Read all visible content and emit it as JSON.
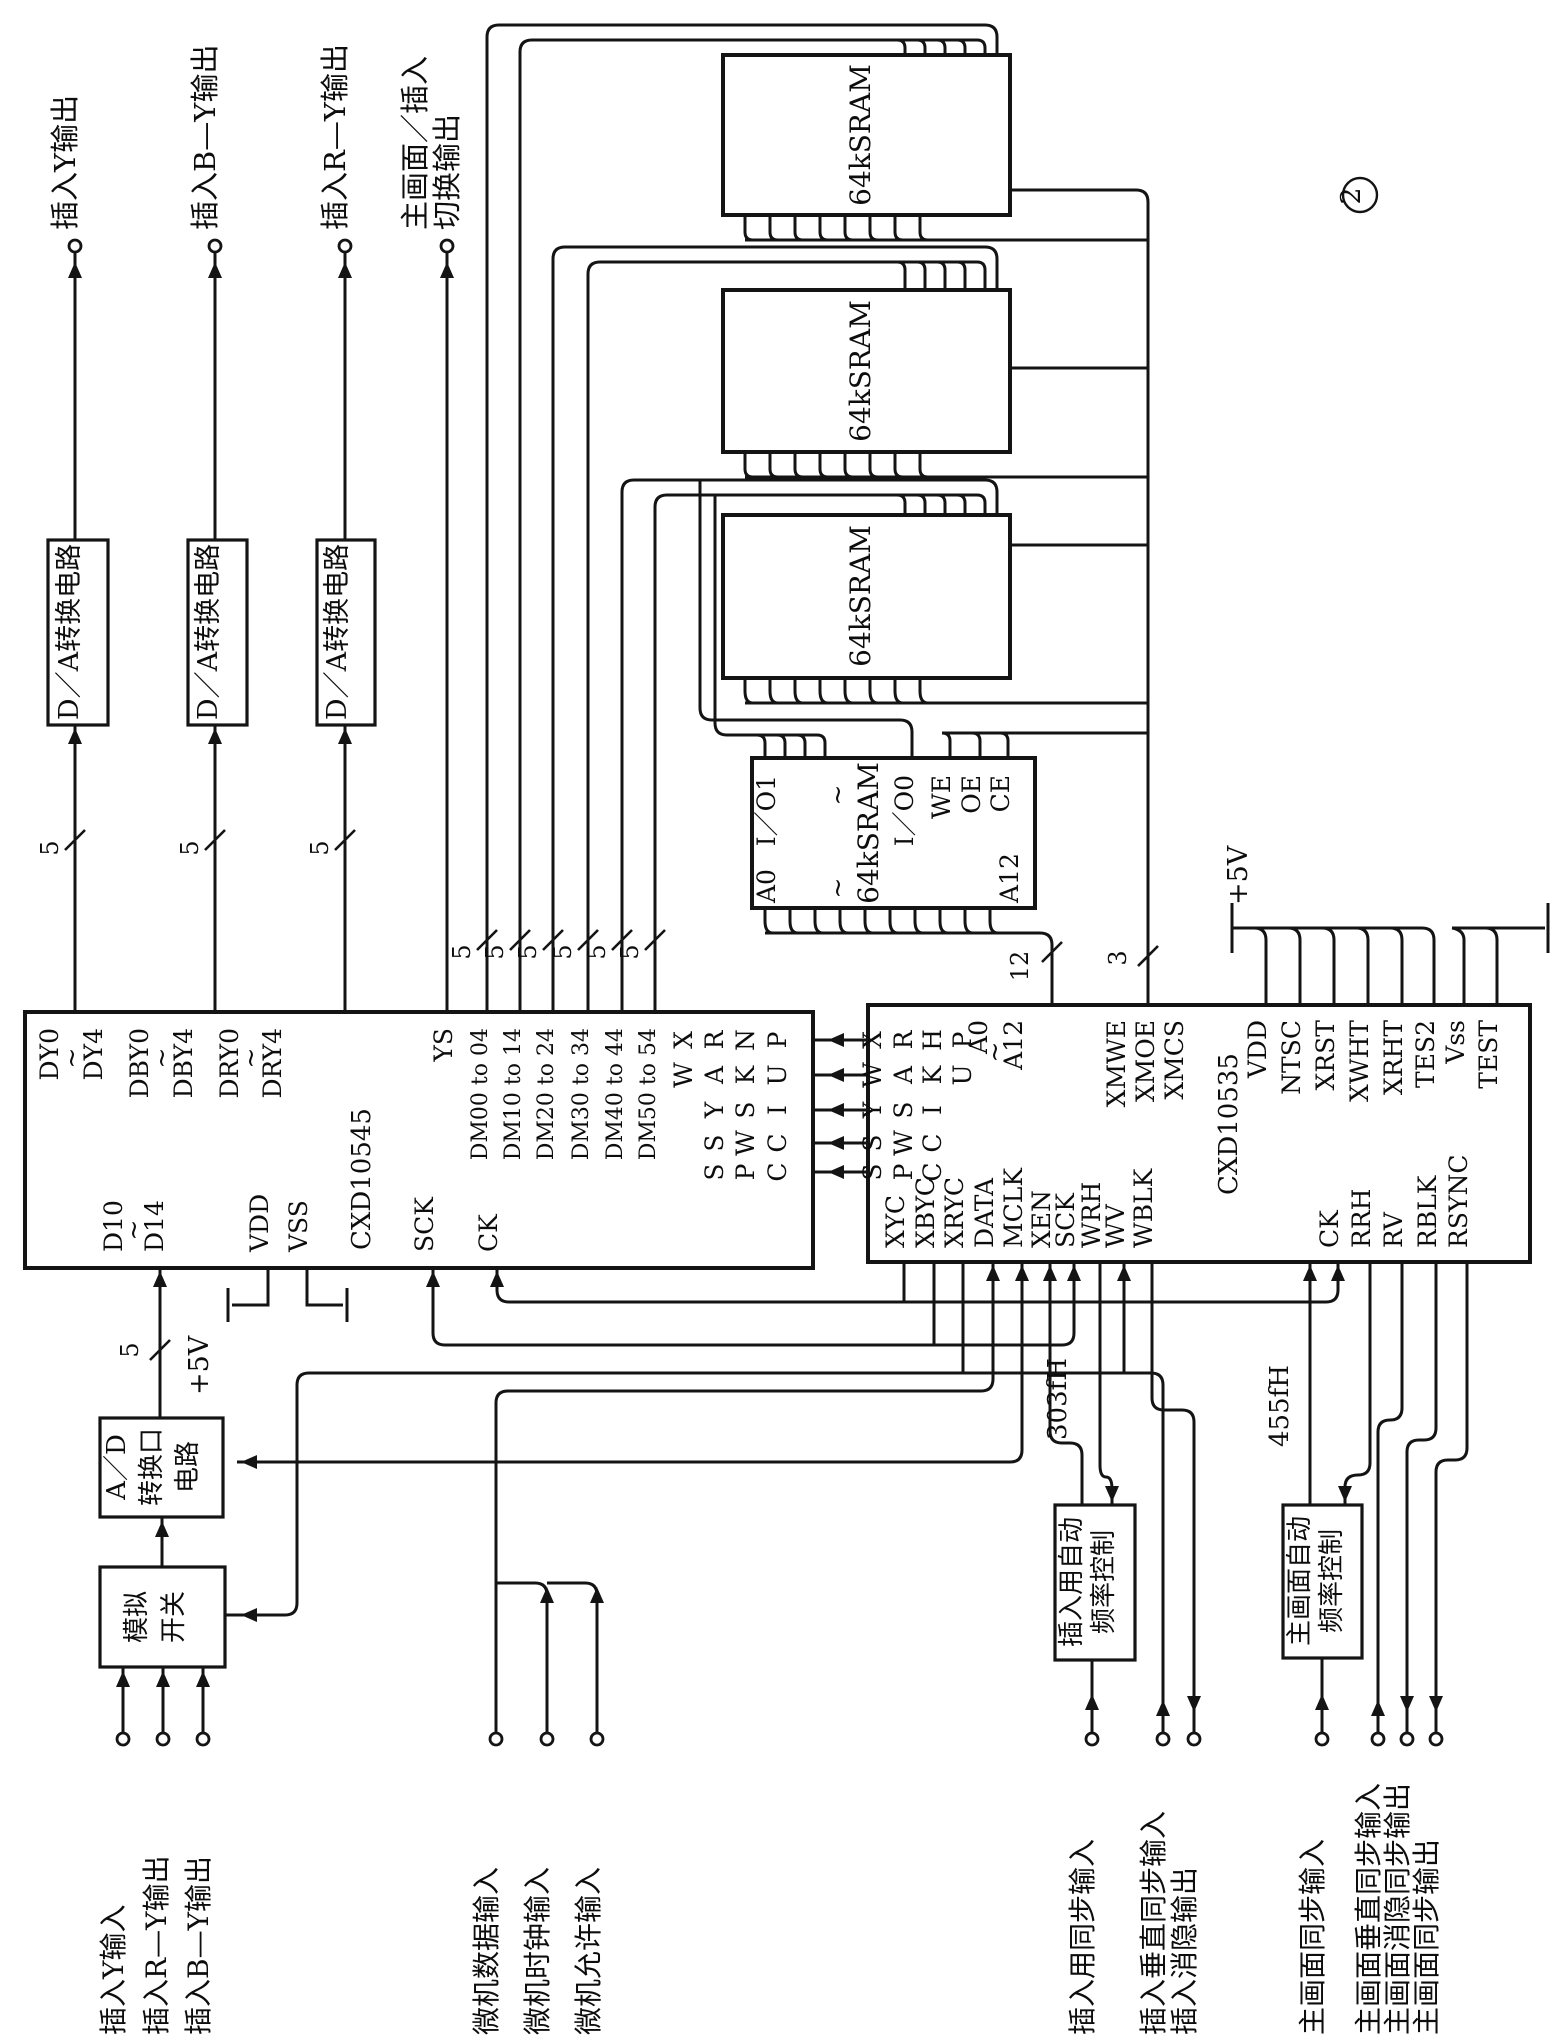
{
  "figure_number": "2",
  "diagram_type": "schematic",
  "main_ics": [
    "CXD10545",
    "CXD10535"
  ],
  "memory_blocks": [
    "64kSRAM",
    "64kSRAM",
    "64kSRAM",
    "64kSRAM"
  ],
  "bus_widths": [
    "5",
    "12",
    "3"
  ],
  "power": [
    "+5V",
    "+5V"
  ],
  "frequencies": [
    "303fH",
    "455fH"
  ],
  "labels": [
    {
      "id": "terminal-label-insert-y-out",
      "t": "插入Y输出",
      "x": 75,
      "y": 230,
      "a": "s",
      "fs": 29
    },
    {
      "id": "terminal-label-insert-by-out",
      "t": "插入B—Y输出",
      "x": 215,
      "y": 230,
      "a": "s",
      "fs": 29
    },
    {
      "id": "terminal-label-insert-ry-out",
      "t": "插入R—Y输出",
      "x": 345,
      "y": 230,
      "a": "s",
      "fs": 29
    },
    {
      "id": "terminal-label-main-insert-switch-1",
      "t": "主画面／插入",
      "x": 425,
      "y": 230,
      "a": "s",
      "fs": 29
    },
    {
      "id": "terminal-label-main-insert-switch-2",
      "t": "切换输出",
      "x": 457,
      "y": 230,
      "a": "s",
      "fs": 29
    },
    {
      "id": "da-box-1-label",
      "t": "D／A转换电路",
      "x": 78,
      "y": 632,
      "a": "m",
      "fs": 27
    },
    {
      "id": "da-box-2-label",
      "t": "D／A转换电路",
      "x": 217,
      "y": 632,
      "a": "m",
      "fs": 27
    },
    {
      "id": "da-box-3-label",
      "t": "D／A转换电路",
      "x": 346,
      "y": 632,
      "a": "m",
      "fs": 27
    },
    {
      "id": "pin-dy0",
      "t": "DY0",
      "x": 58,
      "y": 1028,
      "a": "e"
    },
    {
      "id": "tilde-dy",
      "t": "~",
      "x": 80,
      "y": 1058
    },
    {
      "id": "pin-dy4",
      "t": "DY4",
      "x": 102,
      "y": 1028,
      "a": "e"
    },
    {
      "id": "pin-dby0",
      "t": "DBY0",
      "x": 148,
      "y": 1028,
      "a": "e"
    },
    {
      "id": "tilde-dby",
      "t": "~",
      "x": 170,
      "y": 1058
    },
    {
      "id": "pin-dby4",
      "t": "DBY4",
      "x": 192,
      "y": 1028,
      "a": "e"
    },
    {
      "id": "pin-dry0",
      "t": "DRY0",
      "x": 238,
      "y": 1028,
      "a": "e"
    },
    {
      "id": "tilde-dry",
      "t": "~",
      "x": 259,
      "y": 1058
    },
    {
      "id": "pin-dry4",
      "t": "DRY4",
      "x": 281,
      "y": 1028,
      "a": "e"
    },
    {
      "id": "pin-ys",
      "t": "YS",
      "x": 452,
      "y": 1028,
      "a": "e"
    },
    {
      "id": "pin-dm00",
      "t": "DM00 to 04",
      "x": 487,
      "y": 1028,
      "a": "e",
      "fs": 22
    },
    {
      "id": "pin-dm10",
      "t": "DM10 to 14",
      "x": 520,
      "y": 1028,
      "a": "e",
      "fs": 22
    },
    {
      "id": "pin-dm20",
      "t": "DM20 to 24",
      "x": 553,
      "y": 1028,
      "a": "e",
      "fs": 22
    },
    {
      "id": "pin-dm30",
      "t": "DM30 to 34",
      "x": 588,
      "y": 1028,
      "a": "e",
      "fs": 22
    },
    {
      "id": "pin-dm40",
      "t": "DM40 to 44",
      "x": 622,
      "y": 1028,
      "a": "e",
      "fs": 22
    },
    {
      "id": "pin-dm50",
      "t": "DM50 to 54",
      "x": 655,
      "y": 1028,
      "a": "e",
      "fs": 22
    },
    {
      "id": "pin-45-r1c1",
      "t": "X",
      "x": 692,
      "y": 1040
    },
    {
      "id": "pin-45-r2c1",
      "t": "W",
      "x": 692,
      "y": 1075
    },
    {
      "id": "pin-45-r1c2",
      "t": "R",
      "x": 723,
      "y": 1040
    },
    {
      "id": "pin-45-r2c2",
      "t": "A",
      "x": 723,
      "y": 1075
    },
    {
      "id": "pin-45-r3c2",
      "t": "Y",
      "x": 723,
      "y": 1110
    },
    {
      "id": "pin-45-r4c2",
      "t": "S",
      "x": 723,
      "y": 1143
    },
    {
      "id": "pin-45-r5c2",
      "t": "S",
      "x": 723,
      "y": 1172
    },
    {
      "id": "pin-45-r1c3",
      "t": "N",
      "x": 754,
      "y": 1040
    },
    {
      "id": "pin-45-r2c3",
      "t": "K",
      "x": 754,
      "y": 1075
    },
    {
      "id": "pin-45-r3c3",
      "t": "S",
      "x": 754,
      "y": 1110
    },
    {
      "id": "pin-45-r4c3",
      "t": "W",
      "x": 754,
      "y": 1143
    },
    {
      "id": "pin-45-r5c3",
      "t": "P",
      "x": 754,
      "y": 1172
    },
    {
      "id": "pin-45-r1c4",
      "t": "P",
      "x": 786,
      "y": 1040
    },
    {
      "id": "pin-45-r2c4",
      "t": "U",
      "x": 786,
      "y": 1075
    },
    {
      "id": "pin-45-r3c4",
      "t": "I",
      "x": 786,
      "y": 1110
    },
    {
      "id": "pin-45-r4c4",
      "t": "C",
      "x": 786,
      "y": 1143
    },
    {
      "id": "pin-45-r5c4",
      "t": "C",
      "x": 786,
      "y": 1172
    },
    {
      "id": "pin-d10",
      "t": "D10",
      "x": 122,
      "y": 1252,
      "a": "s"
    },
    {
      "id": "tilde-d1x",
      "t": "~",
      "x": 142,
      "y": 1230
    },
    {
      "id": "pin-d14",
      "t": "D14",
      "x": 163,
      "y": 1252,
      "a": "s"
    },
    {
      "id": "pin-45-vdd",
      "t": "VDD",
      "x": 268,
      "y": 1252,
      "a": "s"
    },
    {
      "id": "pin-45-vss",
      "t": "VSS",
      "x": 307,
      "y": 1252,
      "a": "s"
    },
    {
      "id": "ic-label-cxd10545",
      "t": "CXD10545",
      "x": 370,
      "y": 1250,
      "a": "s",
      "fs": 26
    },
    {
      "id": "pin-45-sck",
      "t": "SCK",
      "x": 433,
      "y": 1252,
      "a": "s"
    },
    {
      "id": "pin-45-ck",
      "t": "CK",
      "x": 497,
      "y": 1252,
      "a": "s"
    },
    {
      "id": "pin-35-r1c1",
      "t": "X",
      "x": 881,
      "y": 1040
    },
    {
      "id": "pin-35-r2c1",
      "t": "W",
      "x": 881,
      "y": 1075
    },
    {
      "id": "pin-35-r3c1",
      "t": "Y",
      "x": 881,
      "y": 1110
    },
    {
      "id": "pin-35-r4c1",
      "t": "S",
      "x": 881,
      "y": 1143
    },
    {
      "id": "pin-35-r5c1",
      "t": "S",
      "x": 881,
      "y": 1172
    },
    {
      "id": "pin-35-r1c2",
      "t": "R",
      "x": 912,
      "y": 1040
    },
    {
      "id": "pin-35-r2c2",
      "t": "A",
      "x": 912,
      "y": 1075
    },
    {
      "id": "pin-35-r3c2",
      "t": "S",
      "x": 912,
      "y": 1110
    },
    {
      "id": "pin-35-r4c2",
      "t": "W",
      "x": 912,
      "y": 1143
    },
    {
      "id": "pin-35-r5c2",
      "t": "P",
      "x": 912,
      "y": 1172
    },
    {
      "id": "pin-35-r1c3",
      "t": "H",
      "x": 941,
      "y": 1040
    },
    {
      "id": "pin-35-r2c3",
      "t": "K",
      "x": 941,
      "y": 1075
    },
    {
      "id": "pin-35-r3c3",
      "t": "I",
      "x": 941,
      "y": 1110
    },
    {
      "id": "pin-35-r4c3",
      "t": "C",
      "x": 941,
      "y": 1143
    },
    {
      "id": "pin-35-r5c3",
      "t": "C",
      "x": 941,
      "y": 1172
    },
    {
      "id": "pin-35-r1c4",
      "t": "P",
      "x": 971,
      "y": 1040
    },
    {
      "id": "pin-35-r2c4",
      "t": "U",
      "x": 971,
      "y": 1075
    },
    {
      "id": "pin-35-a0",
      "t": "A0",
      "x": 987,
      "y": 1020,
      "a": "e"
    },
    {
      "id": "tilde-a",
      "t": "~",
      "x": 1003,
      "y": 1052
    },
    {
      "id": "pin-35-a12",
      "t": "A12",
      "x": 1022,
      "y": 1020,
      "a": "e"
    },
    {
      "id": "pin-xmwe",
      "t": "XMWE",
      "x": 1125,
      "y": 1020,
      "a": "e"
    },
    {
      "id": "pin-xmoe",
      "t": "XMOE",
      "x": 1154,
      "y": 1020,
      "a": "e"
    },
    {
      "id": "pin-xmcs",
      "t": "XMCS",
      "x": 1183,
      "y": 1020,
      "a": "e"
    },
    {
      "id": "pin-35-vdd",
      "t": "VDD",
      "x": 1266,
      "y": 1020,
      "a": "e"
    },
    {
      "id": "pin-ntsc",
      "t": "NTSC",
      "x": 1300,
      "y": 1020,
      "a": "e"
    },
    {
      "id": "pin-xrst",
      "t": "XRST",
      "x": 1334,
      "y": 1020,
      "a": "e"
    },
    {
      "id": "pin-xwht",
      "t": "XWHT",
      "x": 1368,
      "y": 1020,
      "a": "e"
    },
    {
      "id": "pin-xrht",
      "t": "XRHT",
      "x": 1402,
      "y": 1020,
      "a": "e"
    },
    {
      "id": "pin-tes2",
      "t": "TES2",
      "x": 1434,
      "y": 1020,
      "a": "e"
    },
    {
      "id": "pin-35-vss",
      "t": "Vss",
      "x": 1464,
      "y": 1020,
      "a": "e"
    },
    {
      "id": "pin-test",
      "t": "TEST",
      "x": 1497,
      "y": 1020,
      "a": "e"
    },
    {
      "id": "pin-xyc",
      "t": "XYC",
      "x": 904,
      "y": 1248,
      "a": "s"
    },
    {
      "id": "pin-xbyc",
      "t": "XBYC",
      "x": 934,
      "y": 1248,
      "a": "s"
    },
    {
      "id": "pin-xryc",
      "t": "XRYC",
      "x": 963,
      "y": 1248,
      "a": "s"
    },
    {
      "id": "pin-data",
      "t": "DATA",
      "x": 993,
      "y": 1248,
      "a": "s"
    },
    {
      "id": "pin-mclk",
      "t": "MCLK",
      "x": 1022,
      "y": 1248,
      "a": "s"
    },
    {
      "id": "pin-xen",
      "t": "XEN",
      "x": 1050,
      "y": 1248,
      "a": "s"
    },
    {
      "id": "pin-35-sck",
      "t": "SCK",
      "x": 1074,
      "y": 1248,
      "a": "s"
    },
    {
      "id": "pin-wrh",
      "t": "WRH",
      "x": 1100,
      "y": 1248,
      "a": "s"
    },
    {
      "id": "pin-wv",
      "t": "WV",
      "x": 1124,
      "y": 1248,
      "a": "s"
    },
    {
      "id": "pin-wblk",
      "t": "WBLK",
      "x": 1152,
      "y": 1248,
      "a": "s"
    },
    {
      "id": "ic-label-cxd10535",
      "t": "CXD10535",
      "x": 1237,
      "y": 1195,
      "a": "s",
      "fs": 26
    },
    {
      "id": "pin-35-ck",
      "t": "CK",
      "x": 1338,
      "y": 1248,
      "a": "s"
    },
    {
      "id": "pin-rrh",
      "t": "RRH",
      "x": 1370,
      "y": 1248,
      "a": "s"
    },
    {
      "id": "pin-rv",
      "t": "RV",
      "x": 1402,
      "y": 1248,
      "a": "s"
    },
    {
      "id": "pin-rblk",
      "t": "RBLK",
      "x": 1436,
      "y": 1248,
      "a": "s"
    },
    {
      "id": "pin-rsync",
      "t": "RSYNC",
      "x": 1467,
      "y": 1248,
      "a": "s"
    },
    {
      "id": "sram1-label",
      "t": "64kSRAM",
      "x": 870,
      "y": 135,
      "a": "m",
      "fs": 28
    },
    {
      "id": "sram2-label",
      "t": "64kSRAM",
      "x": 870,
      "y": 371,
      "a": "m",
      "fs": 28
    },
    {
      "id": "sram3-label",
      "t": "64kSRAM",
      "x": 870,
      "y": 596,
      "a": "m",
      "fs": 28
    },
    {
      "id": "sram4-label",
      "t": "64kSRAM",
      "x": 878,
      "y": 833,
      "a": "m",
      "fs": 28
    },
    {
      "id": "sram4-pin-io1",
      "t": "I／O1",
      "x": 775,
      "y": 775,
      "a": "e"
    },
    {
      "id": "sram4-pin-a0",
      "t": "A0",
      "x": 775,
      "y": 903,
      "a": "s"
    },
    {
      "id": "sram4-tilde-top",
      "t": "~",
      "x": 846,
      "y": 795
    },
    {
      "id": "sram4-tilde-bot",
      "t": "~",
      "x": 846,
      "y": 888
    },
    {
      "id": "sram4-pin-io0",
      "t": "I／O0",
      "x": 913,
      "y": 775,
      "a": "e"
    },
    {
      "id": "sram4-pin-we",
      "t": "WE",
      "x": 950,
      "y": 775,
      "a": "e"
    },
    {
      "id": "sram4-pin-oe",
      "t": "OE",
      "x": 980,
      "y": 775,
      "a": "e"
    },
    {
      "id": "sram4-pin-ce",
      "t": "CE",
      "x": 1009,
      "y": 775,
      "a": "e"
    },
    {
      "id": "sram4-pin-a12",
      "t": "A12",
      "x": 1018,
      "y": 903,
      "a": "s"
    },
    {
      "id": "bus5-da1",
      "t": "5",
      "x": 58,
      "y": 848,
      "fs": 24
    },
    {
      "id": "bus5-da2",
      "t": "5",
      "x": 198,
      "y": 848,
      "fs": 24
    },
    {
      "id": "bus5-da3",
      "t": "5",
      "x": 328,
      "y": 848,
      "fs": 24
    },
    {
      "id": "bus5-dm00",
      "t": "5",
      "x": 470,
      "y": 952,
      "fs": 24
    },
    {
      "id": "bus5-dm10",
      "t": "5",
      "x": 503,
      "y": 952,
      "fs": 24
    },
    {
      "id": "bus5-dm20",
      "t": "5",
      "x": 536,
      "y": 952,
      "fs": 24
    },
    {
      "id": "bus5-dm30",
      "t": "5",
      "x": 571,
      "y": 952,
      "fs": 24
    },
    {
      "id": "bus5-dm40",
      "t": "5",
      "x": 605,
      "y": 952,
      "fs": 24
    },
    {
      "id": "bus5-dm50",
      "t": "5",
      "x": 638,
      "y": 952,
      "fs": 24
    },
    {
      "id": "bus5-d1x",
      "t": "5",
      "x": 138,
      "y": 1350,
      "fs": 24
    },
    {
      "id": "bus12-addr",
      "t": "12",
      "x": 1028,
      "y": 966,
      "fs": 24
    },
    {
      "id": "bus3-ctl",
      "t": "3",
      "x": 1126,
      "y": 958,
      "fs": 24
    },
    {
      "id": "power-5v-right",
      "t": "+5V",
      "x": 1247,
      "y": 905,
      "a": "s",
      "fs": 27
    },
    {
      "id": "power-5v-left",
      "t": "+5V",
      "x": 208,
      "y": 1395,
      "a": "s",
      "fs": 27
    },
    {
      "id": "afc-insert-label-1",
      "t": "插入用自动",
      "x": 1080,
      "y": 1582,
      "a": "m",
      "fs": 26
    },
    {
      "id": "afc-insert-label-2",
      "t": "频率控制",
      "x": 1112,
      "y": 1582,
      "a": "m",
      "fs": 26
    },
    {
      "id": "afc-main-label-1",
      "t": "主画面自动",
      "x": 1308,
      "y": 1581,
      "a": "m",
      "fs": 26
    },
    {
      "id": "afc-main-label-2",
      "t": "频率控制",
      "x": 1340,
      "y": 1581,
      "a": "m",
      "fs": 26
    },
    {
      "id": "ad-box-label-1",
      "t": "A／D",
      "x": 125,
      "y": 1467,
      "a": "m",
      "fs": 26
    },
    {
      "id": "ad-box-label-2",
      "t": "转换口",
      "x": 160,
      "y": 1467,
      "a": "m",
      "fs": 26
    },
    {
      "id": "ad-box-label-3",
      "t": "电路",
      "x": 196,
      "y": 1467,
      "a": "m",
      "fs": 26
    },
    {
      "id": "switch-box-label-1",
      "t": "模拟",
      "x": 145,
      "y": 1617,
      "a": "m",
      "fs": 26
    },
    {
      "id": "switch-box-label-2",
      "t": "开关",
      "x": 182,
      "y": 1617,
      "a": "m",
      "fs": 26
    },
    {
      "id": "freq-303fh",
      "t": "303fH",
      "x": 1066,
      "y": 1440,
      "a": "s",
      "fs": 26
    },
    {
      "id": "freq-455fh",
      "t": "455fH",
      "x": 1288,
      "y": 1447,
      "a": "s",
      "fs": 26
    },
    {
      "id": "terminal-label-insert-y-in",
      "t": "插入Y输入",
      "x": 123,
      "y": 2035,
      "a": "s",
      "fs": 28
    },
    {
      "id": "terminal-label-insert-ry",
      "t": "插入R—Y输出",
      "x": 166,
      "y": 2035,
      "a": "s",
      "fs": 28
    },
    {
      "id": "terminal-label-insert-by",
      "t": "插入B—Y输出",
      "x": 208,
      "y": 2035,
      "a": "s",
      "fs": 28
    },
    {
      "id": "terminal-label-mcu-data",
      "t": "微机数据输入",
      "x": 496,
      "y": 2035,
      "a": "s",
      "fs": 28
    },
    {
      "id": "terminal-label-mcu-clock",
      "t": "微机时钟输入",
      "x": 547,
      "y": 2035,
      "a": "s",
      "fs": 28
    },
    {
      "id": "terminal-label-mcu-enable",
      "t": "微机允许输入",
      "x": 598,
      "y": 2035,
      "a": "s",
      "fs": 28
    },
    {
      "id": "terminal-label-insert-sync-in",
      "t": "插入用同步输入",
      "x": 1092,
      "y": 2035,
      "a": "s",
      "fs": 28
    },
    {
      "id": "terminal-label-insert-vsync-in",
      "t": "插入垂直同步输入",
      "x": 1163,
      "y": 2035,
      "a": "s",
      "fs": 28
    },
    {
      "id": "terminal-label-insert-blank-out",
      "t": "插入消隐输出",
      "x": 1194,
      "y": 2035,
      "a": "s",
      "fs": 28
    },
    {
      "id": "terminal-label-main-sync-in",
      "t": "主画面同步输入",
      "x": 1322,
      "y": 2035,
      "a": "s",
      "fs": 28
    },
    {
      "id": "terminal-label-main-vsync-in",
      "t": "主画面垂直同步输入",
      "x": 1378,
      "y": 2035,
      "a": "s",
      "fs": 28
    },
    {
      "id": "terminal-label-main-blank-sync-out",
      "t": "主画面消隐同步输出",
      "x": 1407,
      "y": 2035,
      "a": "s",
      "fs": 28
    },
    {
      "id": "terminal-label-main-sync-out",
      "t": "主画面同步输出",
      "x": 1436,
      "y": 2035,
      "a": "s",
      "fs": 28
    },
    {
      "id": "figure-number",
      "t": "2",
      "x": 1360,
      "y": 196,
      "a": "m",
      "fs": 27
    }
  ]
}
